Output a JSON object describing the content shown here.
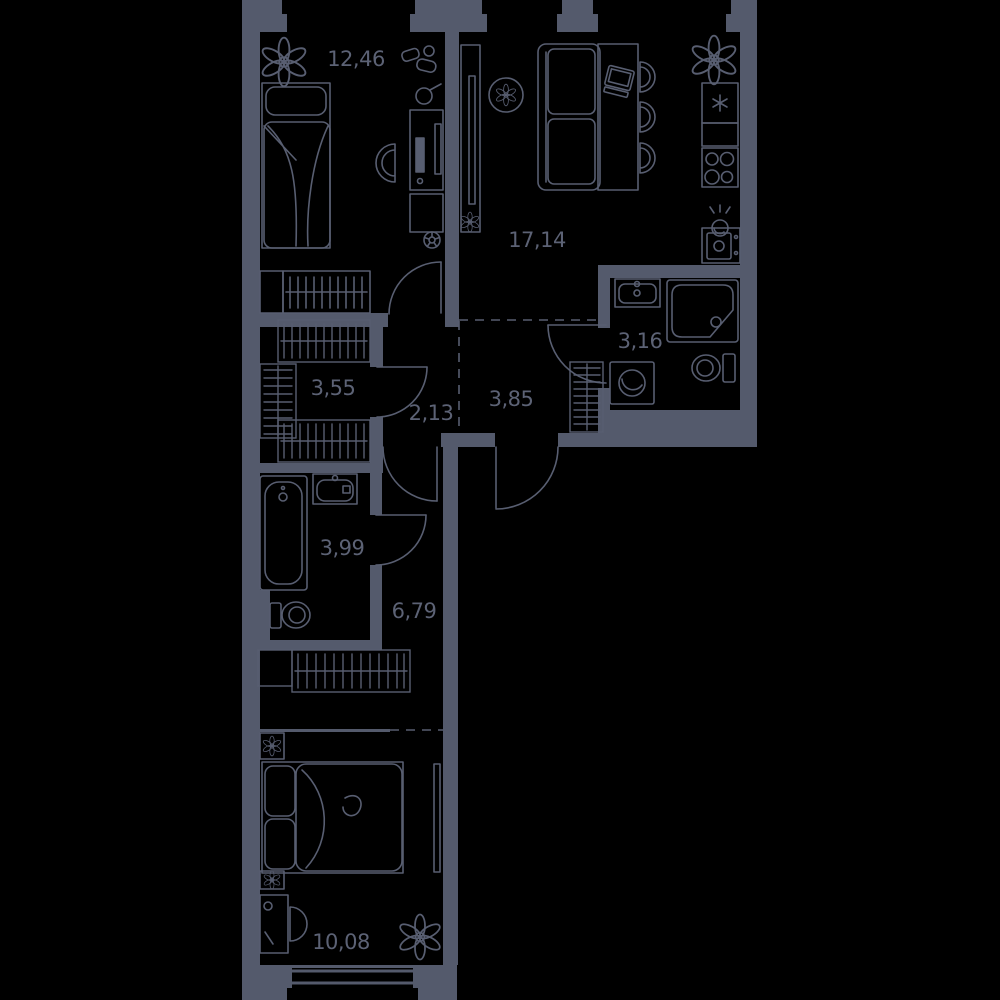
{
  "plan": {
    "type": "apartment-floor-plan",
    "background_color": "#000000",
    "wall_color": "#545a6c",
    "line_color": "#585e71",
    "label_color": "#5c6275",
    "rooms": [
      {
        "id": "bedroom-upper",
        "area": "12,46",
        "furniture": [
          "plant",
          "toys",
          "single-bed",
          "wardrobe-rail",
          "shelf",
          "desk",
          "monitor",
          "keyboard",
          "desk-lamp",
          "desk-chair",
          "cabinet",
          "football"
        ]
      },
      {
        "id": "kitchen-living-room",
        "area": "17,14",
        "furniture": [
          "tv-stand",
          "tv",
          "plant-pot",
          "round-side-table",
          "sofa",
          "dining-table",
          "laptop",
          "bar-chairs",
          "plant",
          "fridge",
          "counter",
          "stove",
          "kitchen-sink",
          "oven"
        ]
      },
      {
        "id": "bathroom-small",
        "area": "3,16",
        "furniture": [
          "wash-basin",
          "shower-cabin",
          "toilet",
          "washing-machine"
        ]
      },
      {
        "id": "walk-in-closet",
        "area": "3,55",
        "furniture": [
          "clothes-rack-top",
          "clothes-rack-left",
          "clothes-rack-bottom"
        ]
      },
      {
        "id": "hall-inner",
        "area": "2,13",
        "furniture": []
      },
      {
        "id": "entrance-hall",
        "area": "3,85",
        "furniture": [
          "coat-rack"
        ]
      },
      {
        "id": "bathroom-large",
        "area": "3,99",
        "furniture": [
          "bathtub",
          "wash-basin",
          "toilet"
        ]
      },
      {
        "id": "corridor",
        "area": "6,79",
        "furniture": [
          "closet-shelf",
          "clothes-rack"
        ]
      },
      {
        "id": "bedroom-lower",
        "area": "10,08",
        "furniture": [
          "nightstand",
          "plant",
          "double-bed",
          "mirror-wardrobe",
          "dressing-table",
          "chair",
          "plant-large"
        ]
      }
    ]
  }
}
